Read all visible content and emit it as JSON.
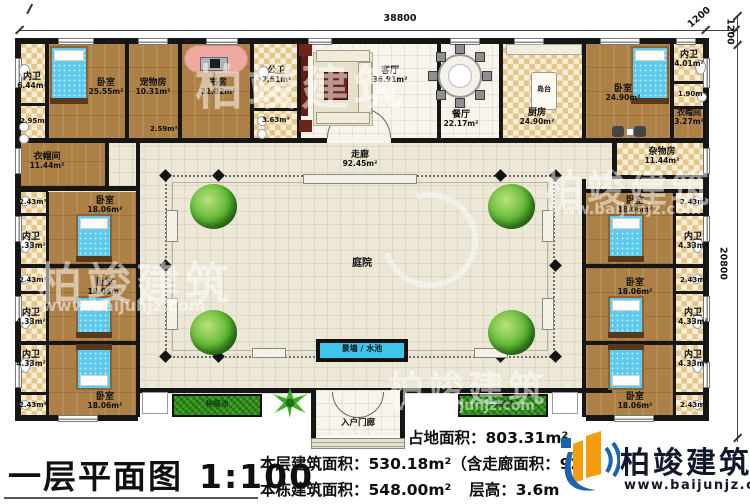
{
  "dims": {
    "top": "38800",
    "corner_a": "1200",
    "corner_b": "1200",
    "right": "20800"
  },
  "rooms": {
    "bath_tl": {
      "name": "内卫",
      "area": "6.44m²"
    },
    "bath_tl_sub": "2.95m²",
    "bedroom_tl": {
      "name": "卧室",
      "area": "25.55m²"
    },
    "pet": {
      "name": "宠物房",
      "area": "10.31m²"
    },
    "study": {
      "name": "书房",
      "area": "22.82m²"
    },
    "pub_bath": {
      "name": "公卫",
      "area": "7.51m²"
    },
    "pub_bath_sub": "3.63m²",
    "living": {
      "name": "客厅",
      "area": "36.91m²"
    },
    "dining": {
      "name": "餐厅",
      "area": "22.17m²"
    },
    "kitchen": {
      "name": "厨房",
      "area": "24.90m²"
    },
    "island": "岛台",
    "bedroom_tr": {
      "name": "卧室",
      "area": "24.90m²"
    },
    "bath_tr": {
      "name": "内卫",
      "area": "4.01m²"
    },
    "bath_tr_sub": "1.90m²",
    "closet_tr": {
      "name": "衣帽间",
      "area": "3.27m²"
    },
    "closet_l": {
      "name": "衣帽间",
      "area": "11.44m²"
    },
    "storage_r": {
      "name": "杂物房",
      "area": "11.44m²"
    },
    "hall_cell": "2.59m²",
    "corridor": {
      "name": "走廊",
      "area": "92.45m²"
    },
    "courtyard": "庭院",
    "pool": "景墙 / 水池",
    "porch": "入户门廊",
    "planter": "种植池",
    "suite": {
      "bedroom": "卧室",
      "bedroom_area": "18.06m²",
      "bath": "内卫",
      "bath_area": "4.33m²",
      "cell": "2.43m²"
    }
  },
  "title_block": {
    "title": "一层平面图",
    "scale": "1:100",
    "site_area": "占地面积：803.31m²",
    "floor_area": "本层建筑面积：530.18m²（含走廊面积：92",
    "building_area": "本栋建筑面积：548.00m²",
    "floor_height": "层高：3.6m"
  },
  "logo": {
    "company": "柏竣建筑",
    "website": "www.baijunjz.com"
  },
  "watermark": {
    "text": "柏竣建筑",
    "website": "www.baijunjz.com"
  }
}
